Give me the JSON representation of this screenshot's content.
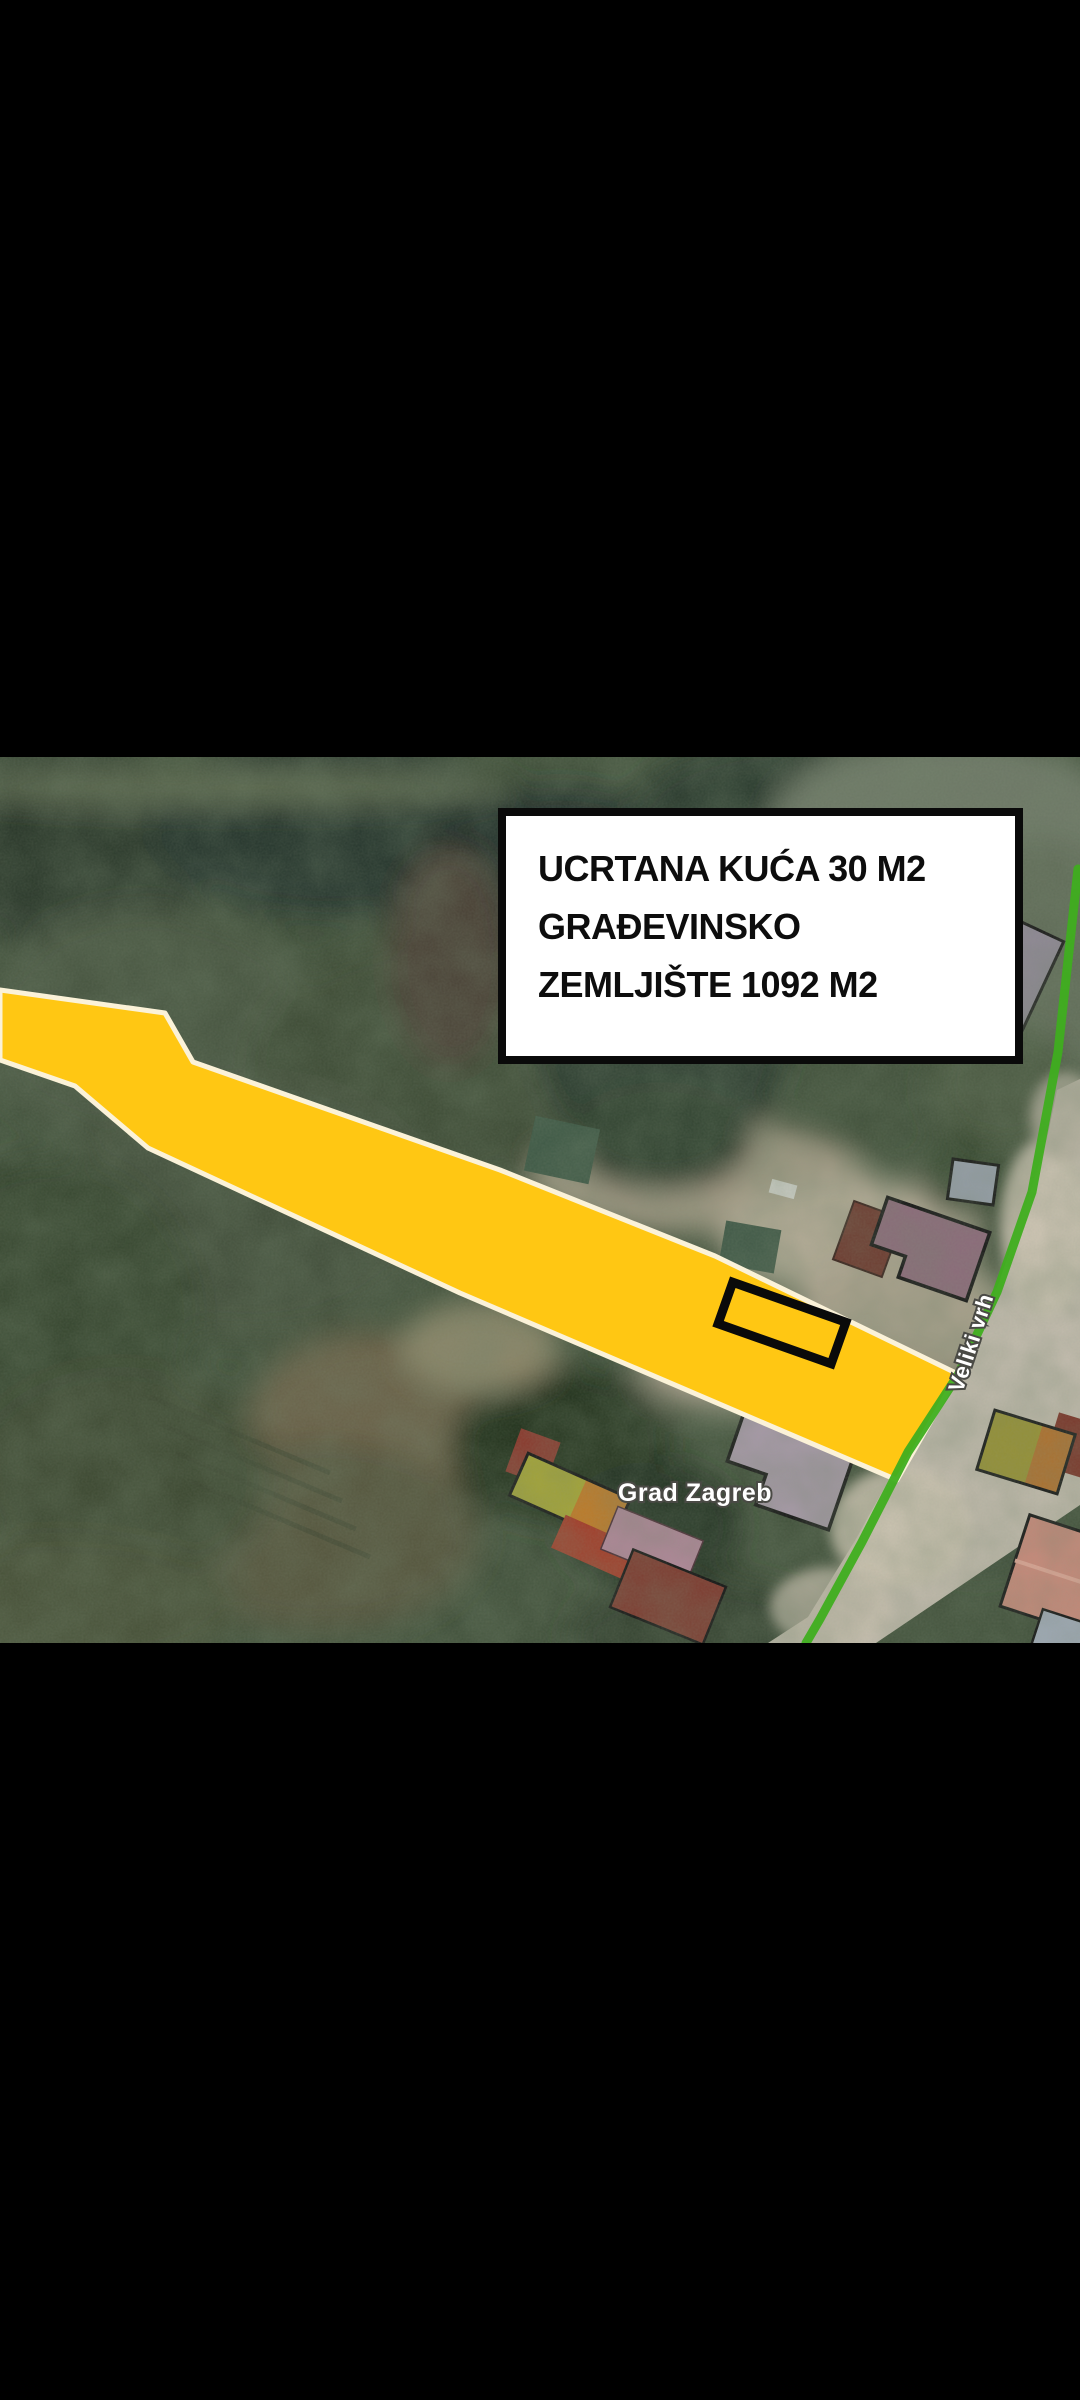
{
  "map": {
    "type": "satellite-cadastral",
    "annotation_box": {
      "line1": "UCRTANA KUĆA 30 M2",
      "line2": "GRAĐEVINSKO",
      "line3": "ZEMLJIŠTE 1092 M2",
      "background": "#FFFFFF",
      "border": "#0A0A0A",
      "text_color": "#0D0D0D"
    },
    "labels": {
      "city": "Grad Zagreb",
      "street": "Veliki vrh"
    },
    "highlight": {
      "parcel_fill": "#FFC713",
      "parcel_border": "#FBF2D8",
      "house_outline": "#0A0A0A",
      "boundary_line": "#3FAE1F"
    },
    "colors": {
      "letterbox": "#000000",
      "forest_base": "#40503A",
      "road": "#C3BCAE",
      "roof_mauve": "#8D6A7B",
      "roof_gray": "#8E8894",
      "roof_dark_red": "#6E362C",
      "roof_salmon": "#C8897A",
      "roof_olive": "#999231",
      "roof_pink": "#B2879A",
      "shed_green": "#3C5744"
    }
  }
}
